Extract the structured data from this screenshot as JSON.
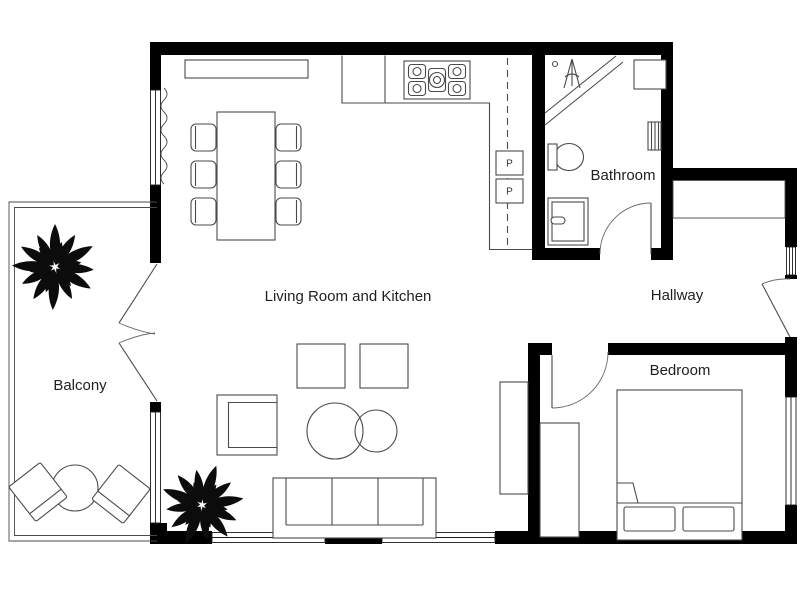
{
  "floorplan": {
    "type": "apartment-floor-plan",
    "rooms": [
      {
        "id": "balcony",
        "label": "Balcony"
      },
      {
        "id": "living-kitchen",
        "label": "Living Room and Kitchen"
      },
      {
        "id": "bathroom",
        "label": "Bathroom"
      },
      {
        "id": "hallway",
        "label": "Hallway"
      },
      {
        "id": "bedroom",
        "label": "Bedroom"
      }
    ],
    "appliances": [
      {
        "id": "kitchen-appliance-1",
        "label": "P"
      },
      {
        "id": "kitchen-appliance-2",
        "label": "P"
      }
    ],
    "fixtures": [
      "dining-table-6-chairs",
      "sideboard",
      "kitchen-counter-L",
      "stove-5-burner",
      "wall-cabinet-dashed-line",
      "shower",
      "shower-head",
      "radiator",
      "toilet",
      "sink",
      "hallway-closet",
      "entry-door-with-sidelight",
      "wardrobe",
      "double-bed-2-pillows",
      "sofa-3-seat",
      "armchair",
      "coffee-tables-round-2",
      "poufs-2",
      "shelf",
      "balcony-table-round",
      "balcony-chairs-2",
      "plants-2",
      "french-doors-to-balcony"
    ],
    "colors": {
      "wall": "#000000",
      "furniture-line": "#4a4a4a",
      "label-text": "#1f1f1f",
      "plant": "#0c0c0c",
      "background": "#ffffff"
    }
  }
}
